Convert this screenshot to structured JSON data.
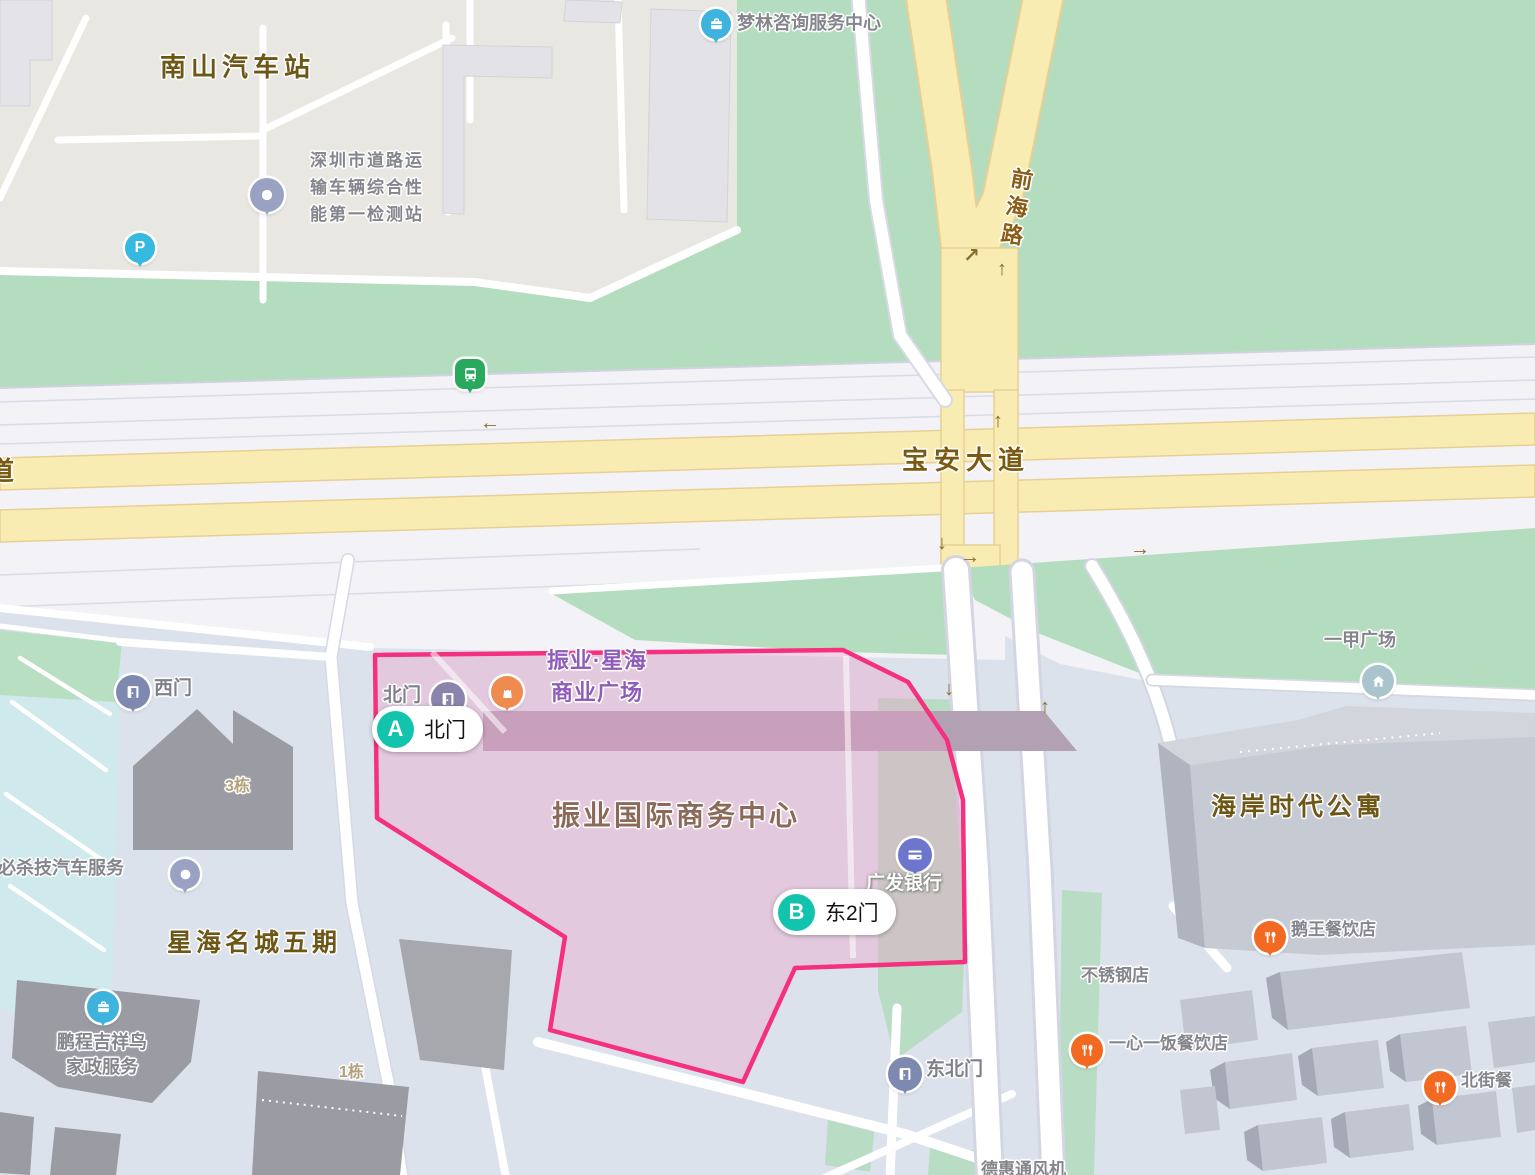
{
  "roads": {
    "baoan": "宝安大道",
    "qianhai": "前海路",
    "partial_left": "道"
  },
  "areas": {
    "nanshan_bus_station": "南山汽车站",
    "xinghai_mingcheng": "星海名城五期",
    "haian_apartment": "海岸时代公寓",
    "zhenye_center": "振业国际商务中心",
    "zhenye_xinghai_plaza": "振业·星海\n商业广场"
  },
  "pois": {
    "detection_station": "深圳市道路运\n输车辆综合性\n能第一检测站",
    "menglin": "梦林咨询服务中心",
    "yijia_plaza": "一甲广场",
    "guangfa_bank": "广发银行",
    "north_gate": "北门",
    "west_gate": "西门",
    "northeast_gate": "东北门",
    "ewang_restaurant": "鹅王餐饮店",
    "stainless_shop": "不锈钢店",
    "yixinyifan_restaurant": "一心一饭餐饮店",
    "beijie_partial": "北街餐",
    "bishaji_auto": "必杀技汽车服务",
    "pengcheng": "鹏程吉祥鸟\n家政服务",
    "dehui_partial": "德惠通风机"
  },
  "buildings": {
    "building3": "3栋",
    "building1": "1栋"
  },
  "markers": {
    "a": {
      "letter": "A",
      "label": "北门"
    },
    "b": {
      "letter": "B",
      "label": "东2门"
    }
  },
  "glyphs": {
    "arrow_left": "←",
    "arrow_right": "→",
    "arrow_up": "↑",
    "arrow_down": "↓",
    "arrow_turn": "↗",
    "parking_letter": "P"
  },
  "colors": {
    "highlight_border": "#f5317f",
    "highlight_fill": "rgba(238,160,200,0.38)",
    "marker_teal": "#12c4ae",
    "road_yellow": "#f9ecb2",
    "area_green": "#b4dcbf",
    "area_beige": "#e9e7e2",
    "area_bluegray": "#dce2eb",
    "pin_food_orange": "#f26a21",
    "pin_shop_orange": "#ef8b4e",
    "pin_blue": "#3db3de",
    "pin_bank": "#6d76cc",
    "pin_gate": "#7e89b0",
    "pin_bus_green": "#28a95d"
  }
}
